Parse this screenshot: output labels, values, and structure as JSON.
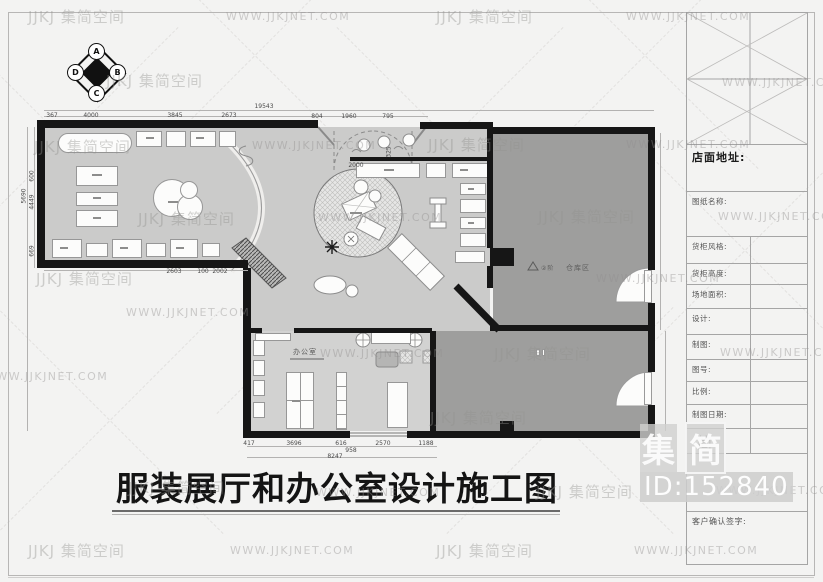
{
  "watermark": {
    "brand": "JJKJ 集简空间",
    "url": "WWW.JJKJNET.COM",
    "big_chars": [
      "集",
      "简"
    ],
    "id_text": "ID:152840",
    "items": [
      {
        "t": "brand",
        "x": 28,
        "y": 6
      },
      {
        "t": "url",
        "x": 226,
        "y": 10
      },
      {
        "t": "brand",
        "x": 436,
        "y": 6
      },
      {
        "t": "url",
        "x": 626,
        "y": 10
      },
      {
        "t": "brand",
        "x": 106,
        "y": 70
      },
      {
        "t": "url",
        "x": 722,
        "y": 76
      },
      {
        "t": "brand",
        "x": 34,
        "y": 136
      },
      {
        "t": "url",
        "x": 252,
        "y": 139
      },
      {
        "t": "brand",
        "x": 428,
        "y": 134
      },
      {
        "t": "url",
        "x": 626,
        "y": 138
      },
      {
        "t": "brand",
        "x": 138,
        "y": 208
      },
      {
        "t": "url",
        "x": 318,
        "y": 211
      },
      {
        "t": "brand",
        "x": 538,
        "y": 206
      },
      {
        "t": "url",
        "x": 718,
        "y": 210
      },
      {
        "t": "brand",
        "x": 36,
        "y": 268
      },
      {
        "t": "url",
        "x": 596,
        "y": 272
      },
      {
        "t": "url",
        "x": 126,
        "y": 306
      },
      {
        "t": "brand",
        "x": 494,
        "y": 343
      },
      {
        "t": "url",
        "x": 320,
        "y": 347
      },
      {
        "t": "url",
        "x": 720,
        "y": 346
      },
      {
        "t": "url",
        "x": -16,
        "y": 370
      },
      {
        "t": "brand",
        "x": 430,
        "y": 407
      },
      {
        "t": "brand",
        "x": 128,
        "y": 477
      },
      {
        "t": "url",
        "x": 316,
        "y": 486
      },
      {
        "t": "brand",
        "x": 536,
        "y": 481
      },
      {
        "t": "url",
        "x": 716,
        "y": 484
      },
      {
        "t": "brand",
        "x": 28,
        "y": 540
      },
      {
        "t": "url",
        "x": 230,
        "y": 544
      },
      {
        "t": "brand",
        "x": 436,
        "y": 540
      },
      {
        "t": "url",
        "x": 634,
        "y": 544
      }
    ]
  },
  "sheet_title": {
    "text": "服装展厅和办公室设计施工图"
  },
  "compass": {
    "letters": [
      "A",
      "B",
      "C",
      "D"
    ]
  },
  "title_block": {
    "fields": [
      "店面地址:",
      "图纸名称:",
      "货柜风格:",
      "货柜高度:",
      "场地面积:",
      "设计:",
      "制图:",
      "图号:",
      "比例:",
      "制图日期:",
      "客户确认签字:"
    ],
    "logo_char": "简"
  },
  "plan": {
    "labels": {
      "office": "办公室",
      "warehouse": "仓库区",
      "warehouse_marker": "②阶"
    },
    "dims": [
      {
        "v": "367",
        "x": 52,
        "y": 112
      },
      {
        "v": "4000",
        "x": 91,
        "y": 112
      },
      {
        "v": "3845",
        "x": 175,
        "y": 112
      },
      {
        "v": "2673",
        "x": 229,
        "y": 112
      },
      {
        "v": "804",
        "x": 317,
        "y": 113
      },
      {
        "v": "1960",
        "x": 349,
        "y": 113
      },
      {
        "v": "795",
        "x": 388,
        "y": 113
      },
      {
        "v": "19543",
        "x": 264,
        "y": 103
      },
      {
        "v": "2000",
        "x": 356,
        "y": 162
      },
      {
        "v": "325",
        "x": 389,
        "y": 152,
        "r": 1
      },
      {
        "v": "5690",
        "x": 24,
        "y": 196,
        "r": 1
      },
      {
        "v": "600",
        "x": 32,
        "y": 176,
        "r": 1
      },
      {
        "v": "4449",
        "x": 32,
        "y": 202,
        "r": 1
      },
      {
        "v": "669",
        "x": 32,
        "y": 251,
        "r": 1
      },
      {
        "v": "2603",
        "x": 174,
        "y": 268
      },
      {
        "v": "100",
        "x": 203,
        "y": 268
      },
      {
        "v": "2002",
        "x": 220,
        "y": 268
      },
      {
        "v": "417",
        "x": 249,
        "y": 440
      },
      {
        "v": "3696",
        "x": 294,
        "y": 440
      },
      {
        "v": "616",
        "x": 341,
        "y": 440
      },
      {
        "v": "2570",
        "x": 383,
        "y": 440
      },
      {
        "v": "1188",
        "x": 426,
        "y": 440
      },
      {
        "v": "958",
        "x": 351,
        "y": 447
      },
      {
        "v": "8247",
        "x": 335,
        "y": 453
      }
    ]
  }
}
